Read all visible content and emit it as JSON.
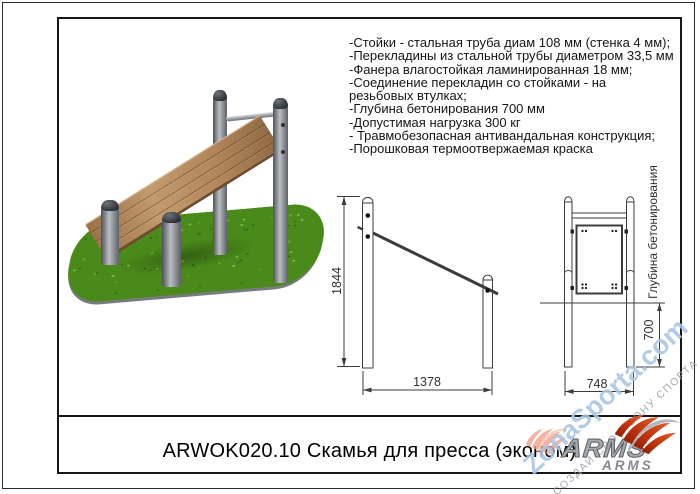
{
  "document": {
    "title": "ARWOK020.10 Скамья для пресса (эконом)"
  },
  "specifications": [
    "-Стойки - стальная труба диам 108 мм (стенка 4 мм);",
    "-Перекладины из стальной трубы диаметром 33,5 мм",
    "-Фанера влагостойкая ламинированная 18 мм;",
    "-Соединение перекладин со стойками - на",
    "резьбовых втулках;",
    "-Глубина бетонирования 700 мм",
    "-Допустимая нагрузка 300 кг",
    "- Травмобезопасная антивандальная конструкция;",
    "-Порошковая термоотвержаемая краска"
  ],
  "drawings": {
    "side_view": {
      "height": "1844",
      "length": "1378"
    },
    "front_view": {
      "width": "748",
      "depth": "700",
      "depth_axis_label": "Глубина бетонирования"
    }
  },
  "branding": {
    "wordmark_large": "ARMS",
    "wordmark_small": "ARMS",
    "accent_red": "#c53a10",
    "steel_gray": "#9aa0a5"
  },
  "watermark": {
    "site": "ZonaSporta.com",
    "slogan": "СОЗДАЙ СВОЮ ЗОНУ СПОРТА",
    "blue": "#a9c6e2"
  },
  "illustration": {
    "grass_green": "#4a8a1a",
    "wood_brown": "#b1845a",
    "metal_gray": "#84898e"
  }
}
